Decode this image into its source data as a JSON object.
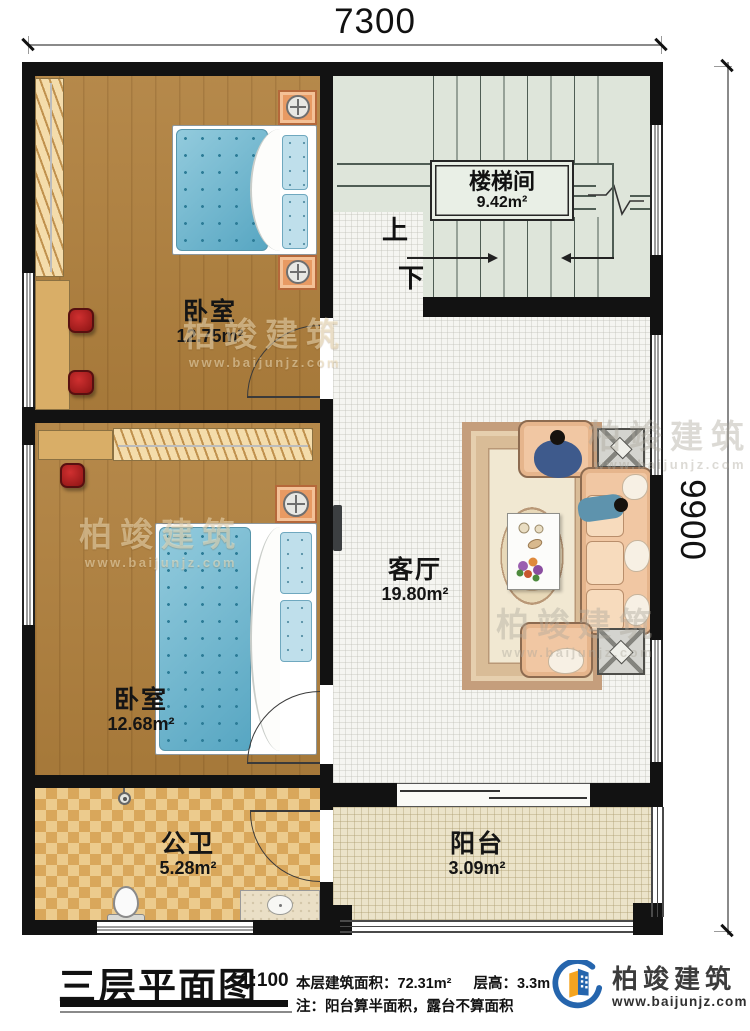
{
  "dimensions": {
    "top": "7300",
    "right": "9900"
  },
  "rooms": {
    "stairwell": {
      "name": "楼梯间",
      "area": "9.42m²"
    },
    "bedroom_top": {
      "name": "卧室",
      "area": "12.75m²"
    },
    "bedroom_bottom": {
      "name": "卧室",
      "area": "12.68m²"
    },
    "living": {
      "name": "客厅",
      "area": "19.80m²"
    },
    "bathroom": {
      "name": "公卫",
      "area": "5.28m²"
    },
    "balcony": {
      "name": "阳台",
      "area": "3.09m²"
    }
  },
  "stairs": {
    "up": "上",
    "down": "下"
  },
  "title_block": {
    "title": "三层平面图",
    "scale": "1:100",
    "floor_area_label": "本层建筑面积：72.31m²",
    "floor_height_label": "层高：3.3m",
    "note": "注：阳台算半面积，露台不算面积"
  },
  "logo": {
    "brand": "柏竣建筑",
    "website": "www.baijunjz.com"
  },
  "watermark": {
    "brand": "柏竣建筑",
    "website": "www.baijunjz.com"
  },
  "colors": {
    "wall": "#121212",
    "wood_floor": "#b0803d",
    "bath_tile": "#d9a75b",
    "stair_floor": "#dee5da",
    "balcony_floor": "#ebe3c9",
    "mattress_blue": "#74b7cf",
    "sofa_peach": "#f1c7a3",
    "logo_blue": "#2565ad",
    "logo_orange": "#f5a41f",
    "stool_red": "#a81c1c"
  }
}
